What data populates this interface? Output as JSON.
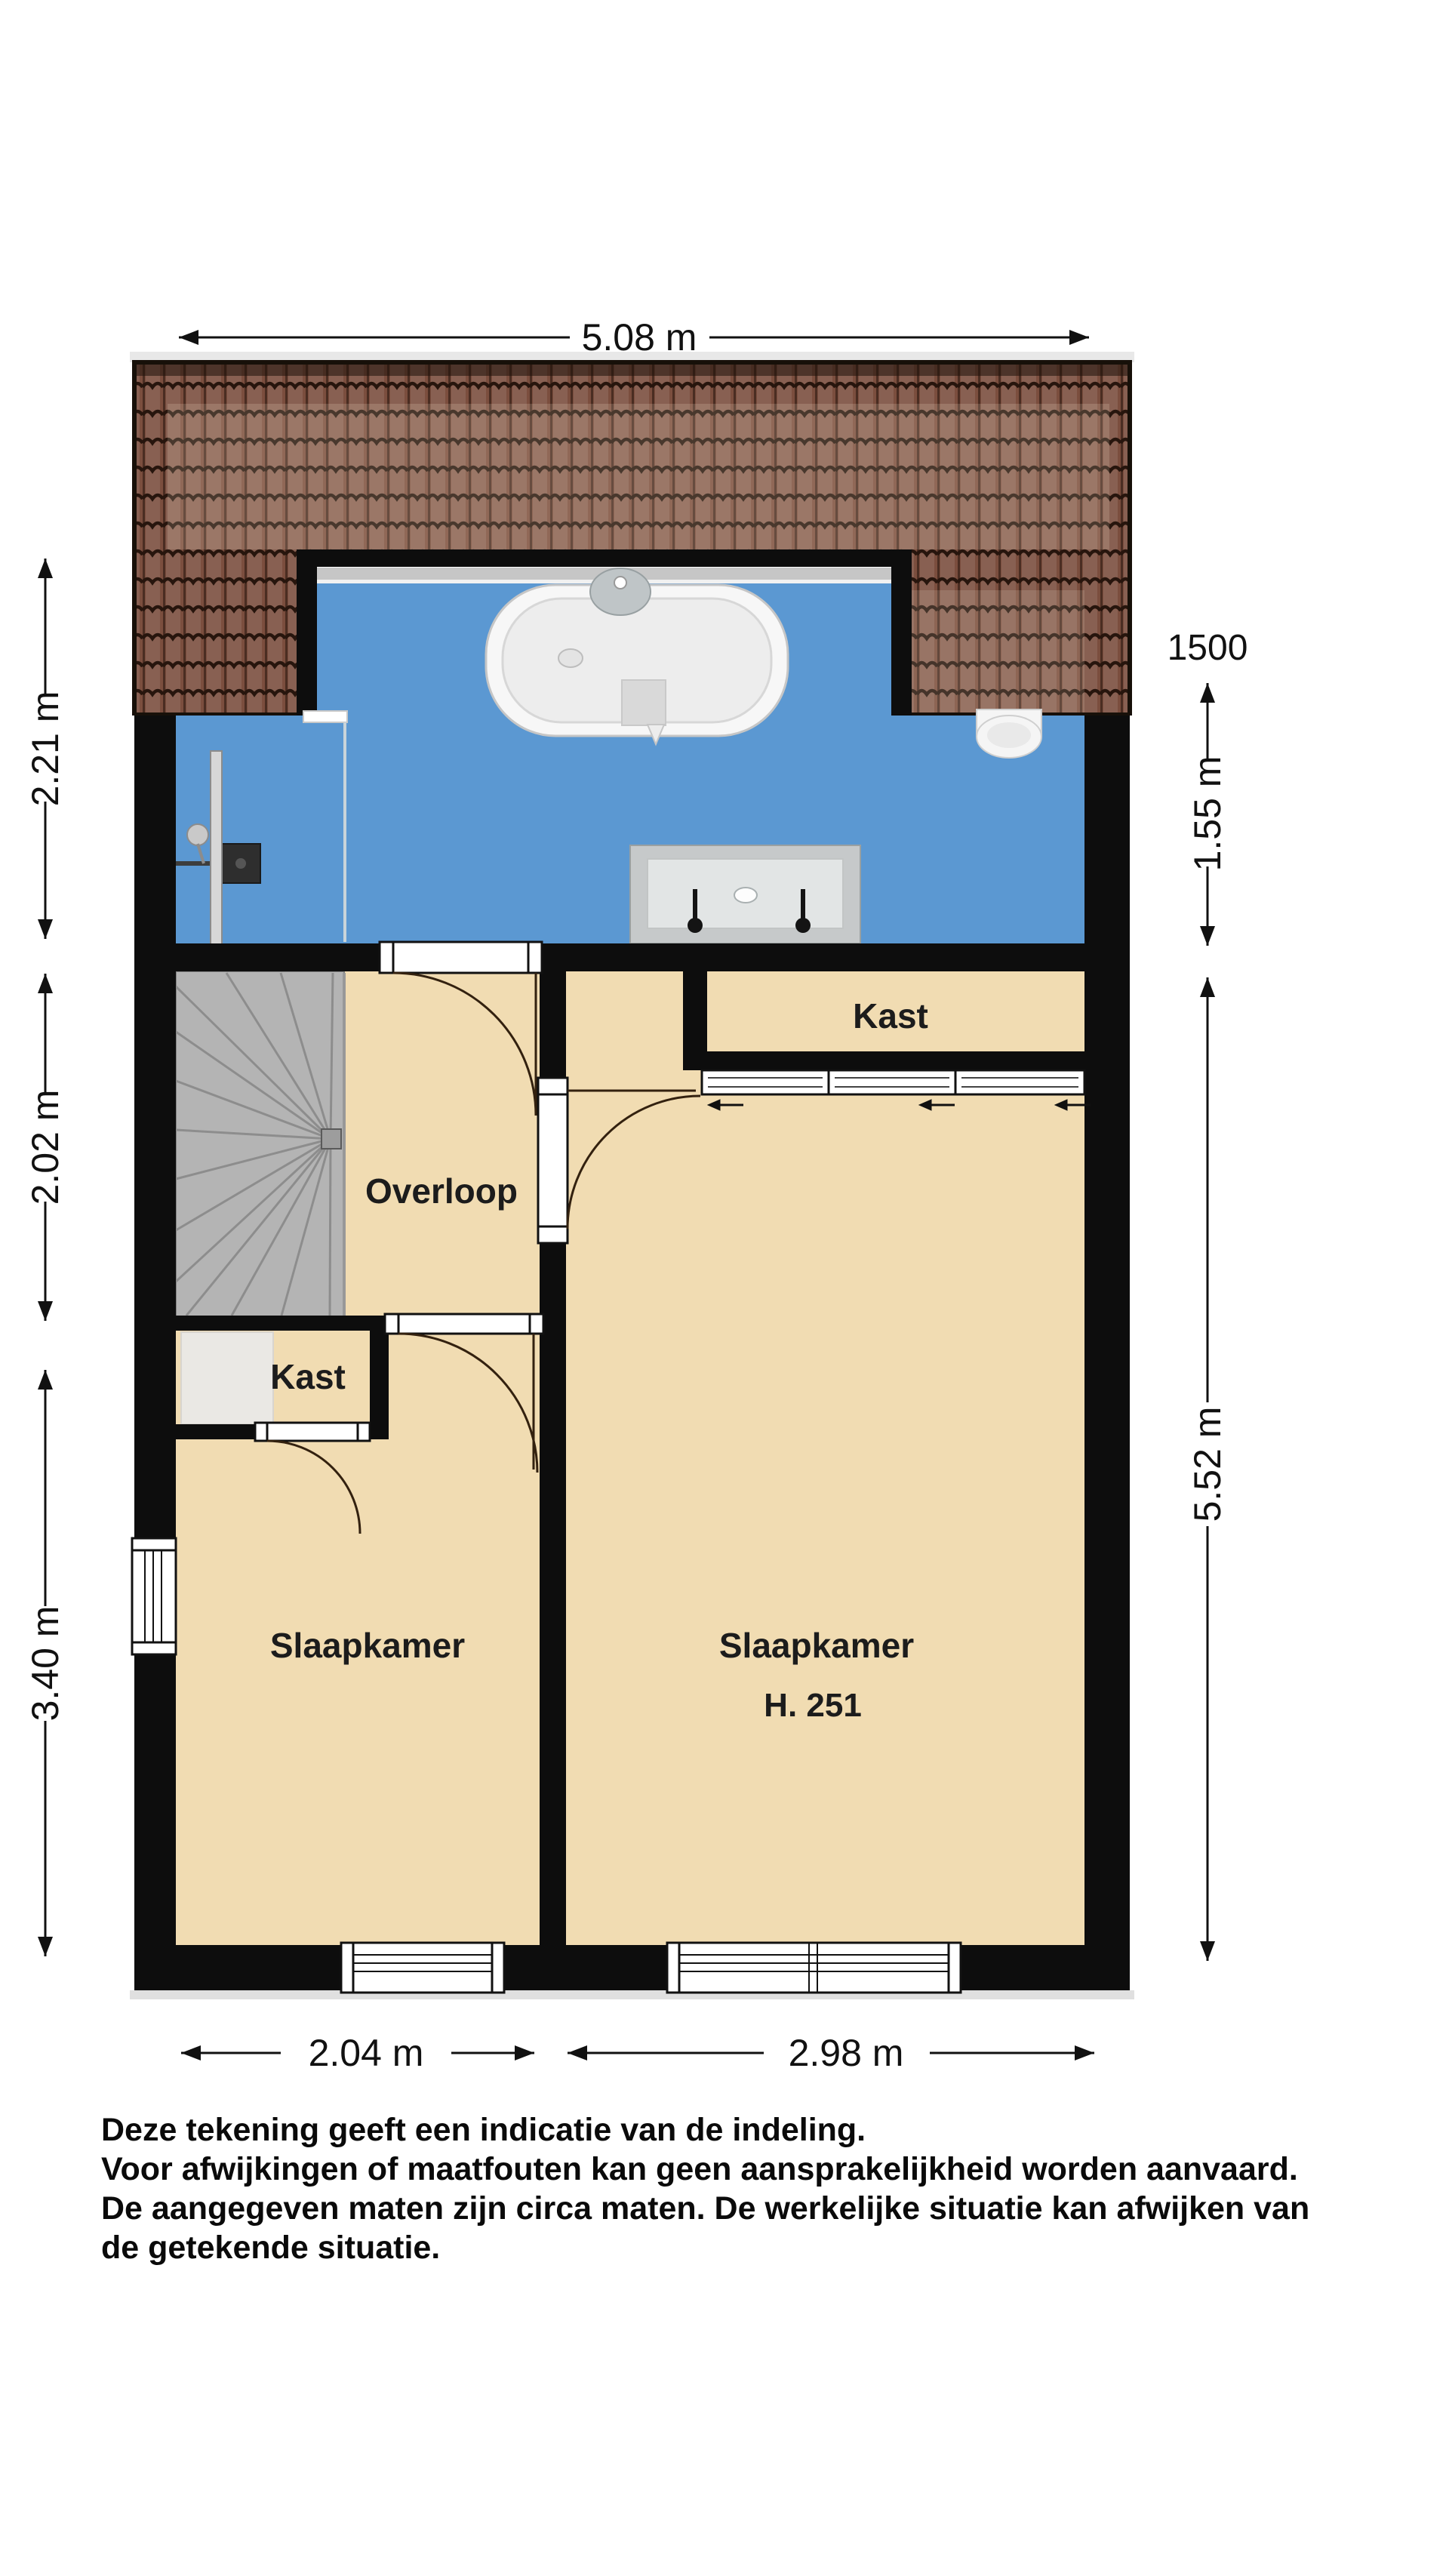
{
  "plan": {
    "colors": {
      "bathroom_floor": "#5b98d2",
      "room_floor": "#f1dcb2",
      "roof_tile": "#7b4e3e",
      "wall": "#0d0d0d",
      "stairs": "#b4b4b4"
    },
    "rooms": {
      "landing": "Overloop",
      "closet_small": "Kast",
      "closet_large": "Kast",
      "bedroom_left": "Slaapkamer",
      "bedroom_right": "Slaapkamer",
      "bedroom_right_height": "H. 251"
    },
    "dimensions": {
      "top": "5.08 m",
      "left_upper": "2.21 m",
      "left_middle": "2.02 m",
      "left_lower": "3.40 m",
      "right_marker": "1500",
      "right_upper": "1.55 m",
      "right_lower": "5.52 m",
      "bottom_left": "2.04 m",
      "bottom_right": "2.98 m"
    },
    "disclaimer": [
      "Deze tekening geeft een indicatie van de indeling.",
      "Voor  afwijkingen of maatfouten kan geen aansprakelijkheid worden aanvaard.",
      "De aangegeven maten zijn circa maten. De werkelijke situatie kan afwijken van",
      "de getekende situatie."
    ]
  }
}
